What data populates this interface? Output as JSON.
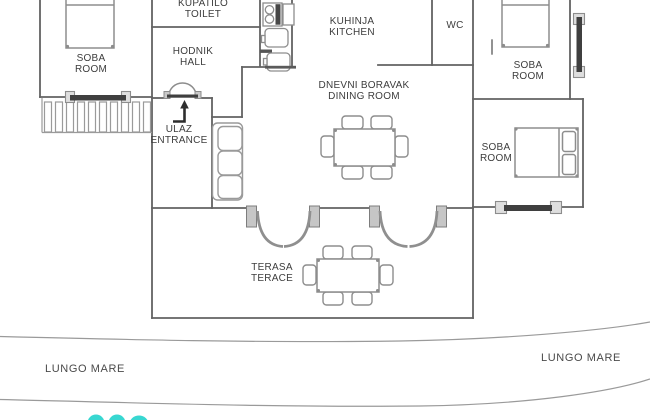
{
  "plan": {
    "rooms": {
      "soba_left": {
        "name_hr": "SOBA",
        "name_en": "ROOM"
      },
      "kupatilo": {
        "name_hr": "KUPATILO",
        "name_en": "TOILET"
      },
      "hodnik": {
        "name_hr": "HODNIK",
        "name_en": "HALL"
      },
      "ulaz": {
        "name_hr": "ULAZ",
        "name_en": "ENTRANCE"
      },
      "kuhinja": {
        "name_hr": "KUHINJA",
        "name_en": "KITCHEN"
      },
      "wc": {
        "name_hr": "WC"
      },
      "dnevni_boravak": {
        "name_hr": "DNEVNI BORAVAK",
        "name_en": "DINING ROOM"
      },
      "soba_top_right": {
        "name_hr": "SOBA",
        "name_en": "ROOM"
      },
      "soba_mid_right": {
        "name_hr": "SOBA",
        "name_en": "ROOM"
      },
      "terasa": {
        "name_hr": "TERASA",
        "name_en": "TERACE"
      }
    },
    "promenade": {
      "label_left": "LUNGO MARE",
      "label_right": "LUNGO MARE"
    },
    "colors": {
      "wall": "#636363",
      "furniture": "#8d8d8d",
      "glazing": "#3f3f3f",
      "logo_accent": "#38d7d1"
    }
  }
}
